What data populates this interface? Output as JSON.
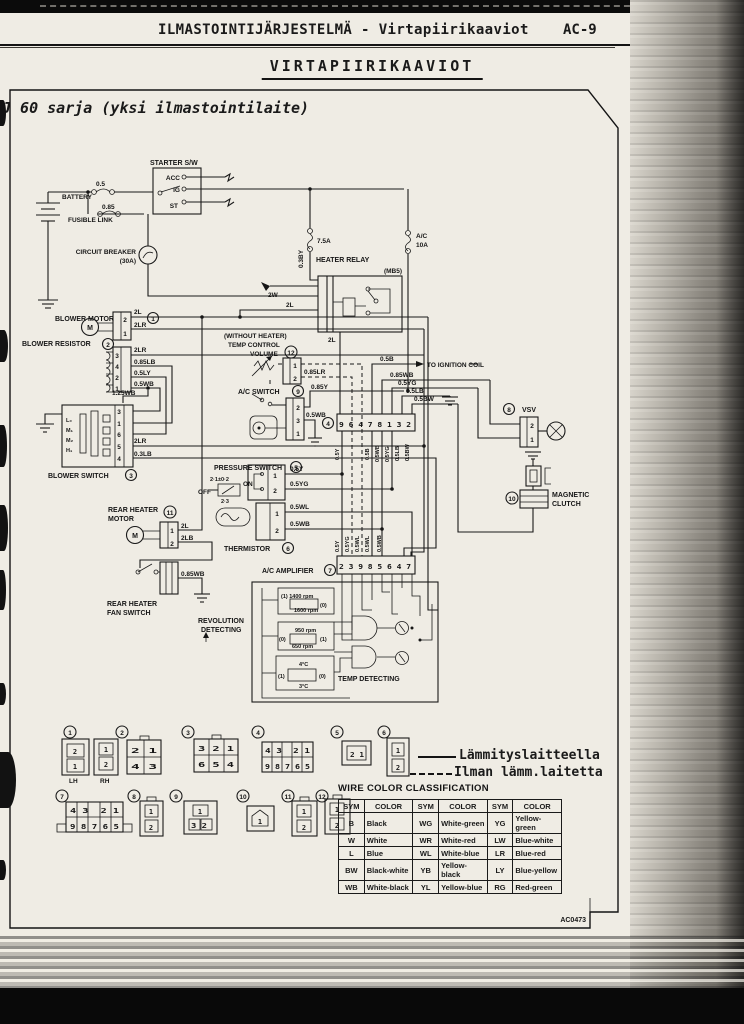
{
  "page": {
    "header_title": "ILMASTOINTIJÄRJESTELMÄ - Virtapiirikaaviot",
    "page_number": "AC-9",
    "section_title": "VIRTAPIIRIKAAVIOT",
    "subtitle": "J 60 sarja (yksi ilmastointilaite)",
    "figure_code": "AC0473"
  },
  "diagram": {
    "labels": {
      "starter_sw": "STARTER S/W",
      "acc": "ACC",
      "ig": "IG",
      "st": "ST",
      "battery": "BATTERY",
      "fusible_link": "FUSIBLE LINK",
      "f05": "0.5",
      "f085": "0.85",
      "cb": "CIRCUIT BREAKER",
      "cb30": "(30A)",
      "f75": "7.5A",
      "w03by": "0.3BY",
      "heater_relay": "HEATER RELAY",
      "mb5": "(MB5)",
      "ac": "A/C",
      "a10": "10A",
      "w2w": "2W",
      "w2l": "2L",
      "w2lr": "2LR",
      "w2lb": "2LB",
      "blower_motor": "BLOWER MOTOR",
      "blower_resistor": "BLOWER RESISTOR",
      "blower_switch": "BLOWER SWITCH",
      "w085lb": "0.85LB",
      "w05ly": "0.5LY",
      "w05wb": "0.5WB",
      "w125wb": "1.25WB",
      "w03lb": "0.3LB",
      "lo": "L₀",
      "m1": "M₁",
      "m2": "M₂",
      "hi": "H₁",
      "m_sym": "M",
      "without_heater": "(WITHOUT HEATER)",
      "temp_control": "TEMP CONTROL",
      "volume": "VOLUME",
      "w085lr": "0.85LR",
      "w05b": "0.5B",
      "to_ign": "TO IGNITION COIL",
      "w085wb": "0.85WB",
      "w05yg": "0.5YG",
      "w05lb": "0.5LB",
      "w05bw": "0.5BW",
      "w085y": "0.85Y",
      "ac_switch": "A/C SWITCH",
      "c4pins": "9 6 4 7 8 1 3 2",
      "vsv": "VSV",
      "pressure_switch": "PRESSURE SWITCH",
      "ps_on_val": "2·1±0·2",
      "on": "ON",
      "off": "OFF",
      "ps_off_val": "2·3",
      "w05y": "0.5Y",
      "thermistor": "THERMISTOR",
      "w05wl": "0.5WL",
      "rear_heater": "REAR HEATER",
      "motor": "MOTOR",
      "fan_switch": "FAN SWITCH",
      "magnetic": "MAGNETIC",
      "clutch": "CLUTCH",
      "ac_amp": "A/C AMPLIFIER",
      "amp_pins": "2 3 9 8 5 6 4 7",
      "revolution": "REVOLUTION",
      "detecting": "DETECTING",
      "temp_detecting": "TEMP DETECTING",
      "r1400": "(1) 1400 rpm",
      "r1600": "1600 rpm",
      "r950": "950 rpm",
      "r650": "650 rpm",
      "t4": "4°C",
      "t3": "3°C",
      "b0": "(0)",
      "b1": "(1)"
    },
    "nums": {
      "n1": "1",
      "n2": "2",
      "n3": "3",
      "n4": "4",
      "n5": "5",
      "n6": "6",
      "n7": "7",
      "n8": "8",
      "n9": "9",
      "n10": "10",
      "n11": "11",
      "n12": "12"
    }
  },
  "connectors": {
    "k1": {
      "lh": "LH",
      "rh": "RH",
      "lh_top": "2",
      "lh_bot": "1",
      "rh_top": "1",
      "rh_bot": "2"
    },
    "k2": {
      "top": "2 1",
      "bot": "4 3"
    },
    "k3": {
      "top": "3 2 1",
      "bot": "6 5 4"
    },
    "k4": {
      "top": "4 3  2 1",
      "bot": "9 8 7 6 5"
    },
    "k5": {
      "top": "2 1"
    },
    "k6": {
      "top": "1",
      "bot": "2"
    },
    "k7": {
      "top": "4 3  2 1",
      "bot": "9 8 7 6 5"
    },
    "k8": {
      "top": "1",
      "bot": "2"
    },
    "k9": {
      "top": "1",
      "bot": "3 2"
    },
    "k10": {
      "top": "1"
    },
    "k11": {
      "top": "1",
      "bot": "2"
    },
    "k12": {
      "top": "1",
      "bot": "2"
    }
  },
  "legend": {
    "solid": "Lämmityslaitteella",
    "dashed": "Ilman lämm.laitetta"
  },
  "color_table": {
    "title": "WIRE COLOR CLASSIFICATION",
    "headers": [
      "SYM",
      "COLOR",
      "SYM",
      "COLOR",
      "SYM",
      "COLOR"
    ],
    "rows": [
      [
        "B",
        "Black",
        "WG",
        "White-green",
        "YG",
        "Yellow-green"
      ],
      [
        "W",
        "White",
        "WR",
        "White-red",
        "LW",
        "Blue-white"
      ],
      [
        "L",
        "Blue",
        "WL",
        "White-blue",
        "LR",
        "Blue-red"
      ],
      [
        "BW",
        "Black-white",
        "YB",
        "Yellow-black",
        "LY",
        "Blue-yellow"
      ],
      [
        "WB",
        "White-black",
        "YL",
        "Yellow-blue",
        "RG",
        "Red-green"
      ]
    ]
  }
}
